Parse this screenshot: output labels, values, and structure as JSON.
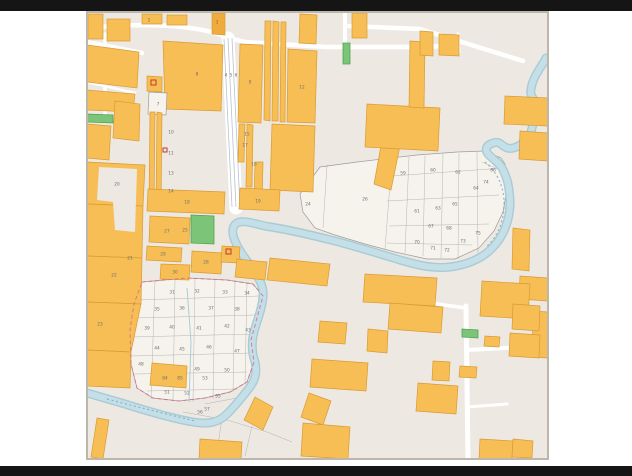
{
  "window": {
    "description": "cadastral parcel map screenshot with letterbox bars"
  },
  "map": {
    "colors": {
      "letterbox": "#151515",
      "page": "#FFFFFF",
      "map-bg": "#EDE9E2",
      "region-bg": "#F6F3ED",
      "orange": "#F6BE55",
      "orange-dark": "#EFAC3C",
      "orange-stroke": "#D99B33",
      "green": "#7CC478",
      "green-stroke": "#4FA352",
      "water": "#C4DFE7",
      "water-edge": "#A8CBD5",
      "water-text": "#6F9CBA",
      "road": "#FFFFFF",
      "lane": "#B9C2CC",
      "gray-line": "#9C9C9C",
      "pink": "#D4708C",
      "label": "#6E6E6E",
      "red": "#C0392B",
      "border": "#BDB6AA"
    },
    "parcel_labels": [
      {
        "t": "2",
        "x": 62,
        "y": 8
      },
      {
        "t": "3",
        "x": 130,
        "y": 10
      },
      {
        "t": "4",
        "x": 139,
        "y": 63
      },
      {
        "t": "5",
        "x": 144,
        "y": 63
      },
      {
        "t": "6",
        "x": 149,
        "y": 63
      },
      {
        "t": "8",
        "x": 110,
        "y": 62
      },
      {
        "t": "9",
        "x": 163,
        "y": 70
      },
      {
        "t": "12",
        "x": 215,
        "y": 75
      },
      {
        "t": "7",
        "x": 71,
        "y": 92
      },
      {
        "t": "10",
        "x": 84,
        "y": 120
      },
      {
        "t": "11",
        "x": 84,
        "y": 141
      },
      {
        "t": "13",
        "x": 84,
        "y": 161
      },
      {
        "t": "14",
        "x": 84,
        "y": 179
      },
      {
        "t": "15",
        "x": 160,
        "y": 122
      },
      {
        "t": "16",
        "x": 167,
        "y": 152
      },
      {
        "t": "17",
        "x": 158,
        "y": 133
      },
      {
        "t": "18",
        "x": 100,
        "y": 190
      },
      {
        "t": "19",
        "x": 171,
        "y": 189
      },
      {
        "t": "20",
        "x": 30,
        "y": 172
      },
      {
        "t": "21",
        "x": 43,
        "y": 246
      },
      {
        "t": "22",
        "x": 27,
        "y": 263
      },
      {
        "t": "23",
        "x": 13,
        "y": 312
      },
      {
        "t": "25",
        "x": 98,
        "y": 218
      },
      {
        "t": "27",
        "x": 80,
        "y": 219
      },
      {
        "t": "28",
        "x": 119,
        "y": 250
      },
      {
        "t": "29",
        "x": 76,
        "y": 242
      },
      {
        "t": "30",
        "x": 88,
        "y": 260
      },
      {
        "t": "24",
        "x": 221,
        "y": 192
      },
      {
        "t": "26",
        "x": 278,
        "y": 187
      },
      {
        "t": "59",
        "x": 316,
        "y": 161
      },
      {
        "t": "60",
        "x": 346,
        "y": 158
      },
      {
        "t": "62",
        "x": 371,
        "y": 160
      },
      {
        "t": "64",
        "x": 389,
        "y": 176
      },
      {
        "t": "66",
        "x": 406,
        "y": 158
      },
      {
        "t": "61",
        "x": 330,
        "y": 199
      },
      {
        "t": "63",
        "x": 351,
        "y": 196
      },
      {
        "t": "65",
        "x": 368,
        "y": 192
      },
      {
        "t": "67",
        "x": 344,
        "y": 214
      },
      {
        "t": "68",
        "x": 362,
        "y": 216
      },
      {
        "t": "70",
        "x": 330,
        "y": 230
      },
      {
        "t": "71",
        "x": 346,
        "y": 236
      },
      {
        "t": "72",
        "x": 360,
        "y": 238
      },
      {
        "t": "73",
        "x": 376,
        "y": 229
      },
      {
        "t": "74",
        "x": 399,
        "y": 170
      },
      {
        "t": "75",
        "x": 391,
        "y": 221
      },
      {
        "t": "31",
        "x": 85,
        "y": 280
      },
      {
        "t": "32",
        "x": 110,
        "y": 279
      },
      {
        "t": "33",
        "x": 138,
        "y": 280
      },
      {
        "t": "34",
        "x": 160,
        "y": 281
      },
      {
        "t": "35",
        "x": 70,
        "y": 297
      },
      {
        "t": "36",
        "x": 95,
        "y": 296
      },
      {
        "t": "37",
        "x": 124,
        "y": 296
      },
      {
        "t": "38",
        "x": 150,
        "y": 297
      },
      {
        "t": "39",
        "x": 60,
        "y": 316
      },
      {
        "t": "40",
        "x": 85,
        "y": 315
      },
      {
        "t": "41",
        "x": 112,
        "y": 316
      },
      {
        "t": "42",
        "x": 140,
        "y": 314
      },
      {
        "t": "43",
        "x": 161,
        "y": 318
      },
      {
        "t": "44",
        "x": 70,
        "y": 336
      },
      {
        "t": "45",
        "x": 95,
        "y": 337
      },
      {
        "t": "46",
        "x": 122,
        "y": 335
      },
      {
        "t": "47",
        "x": 150,
        "y": 339
      },
      {
        "t": "48",
        "x": 54,
        "y": 352
      },
      {
        "t": "49",
        "x": 110,
        "y": 357
      },
      {
        "t": "50",
        "x": 140,
        "y": 358
      },
      {
        "t": "51",
        "x": 80,
        "y": 380
      },
      {
        "t": "52",
        "x": 100,
        "y": 381
      },
      {
        "t": "53",
        "x": 118,
        "y": 366
      },
      {
        "t": "84",
        "x": 78,
        "y": 366
      },
      {
        "t": "85",
        "x": 93,
        "y": 366
      },
      {
        "t": "55",
        "x": 131,
        "y": 384
      },
      {
        "t": "56",
        "x": 113,
        "y": 400
      },
      {
        "t": "57",
        "x": 120,
        "y": 397
      }
    ]
  }
}
